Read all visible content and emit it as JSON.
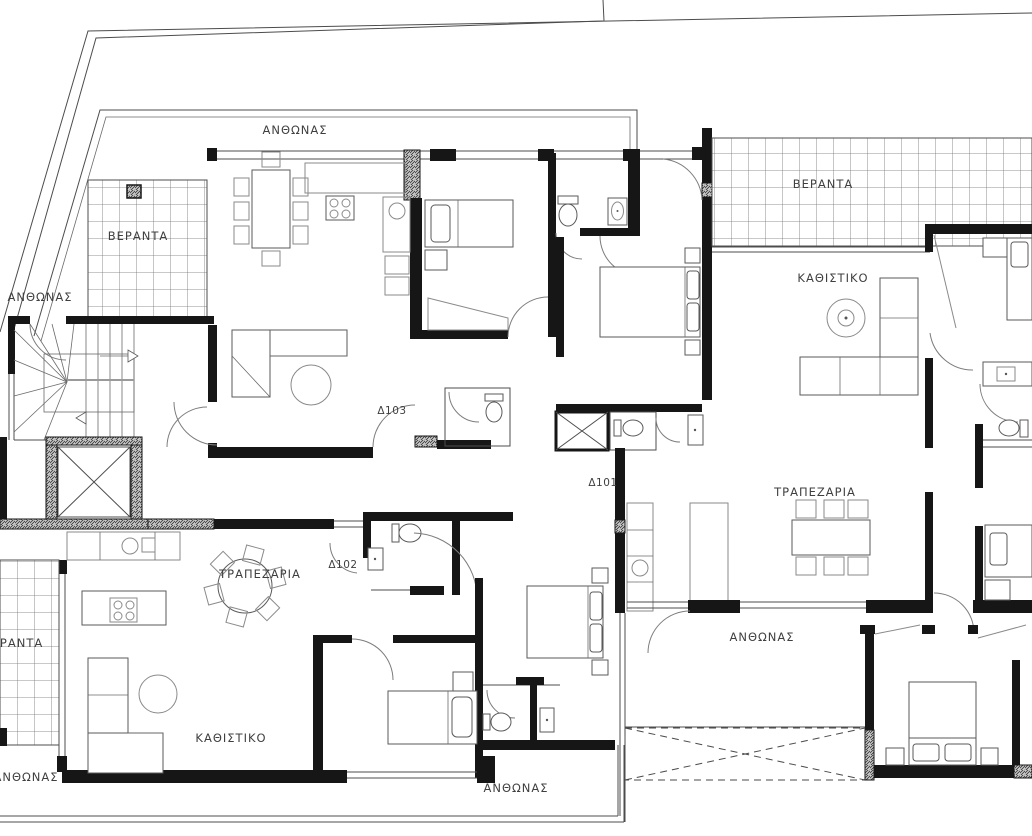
{
  "plan": {
    "labels": {
      "flowerbed_top": "ΑΝΘΩΝΑΣ",
      "flowerbed_left": "ΑΝΘΩΝΑΣ",
      "flowerbed_mid": "ΑΝΘΩΝΑΣ",
      "flowerbed_bottom_left": "ΑΝΘΩΝΑΣ",
      "flowerbed_bottom": "ΑΝΘΩΝΑΣ",
      "veranda_top_left": "ΒΕΡΑΝΤΑ",
      "veranda_top_right": "ΒΕΡΑΝΤΑ",
      "veranda_bottom_left": "ΒΕΡΑΝΤΑ",
      "living_right": "ΚΑΘΙΣΤΙΚΟ",
      "living_left": "ΚΑΘΙΣΤΙΚΟ",
      "dining_right": "ΤΡΑΠΕΖΑΡΙΑ",
      "dining_left": "ΤΡΑΠΕΖΑΡΙΑ",
      "apt_101": "Δ101",
      "apt_102": "Δ102",
      "apt_103": "Δ103"
    },
    "colors": {
      "wall": "#161616",
      "thin_line": "#4c4c4c",
      "label": "#3f3f3f",
      "background": "#ffffff"
    }
  }
}
